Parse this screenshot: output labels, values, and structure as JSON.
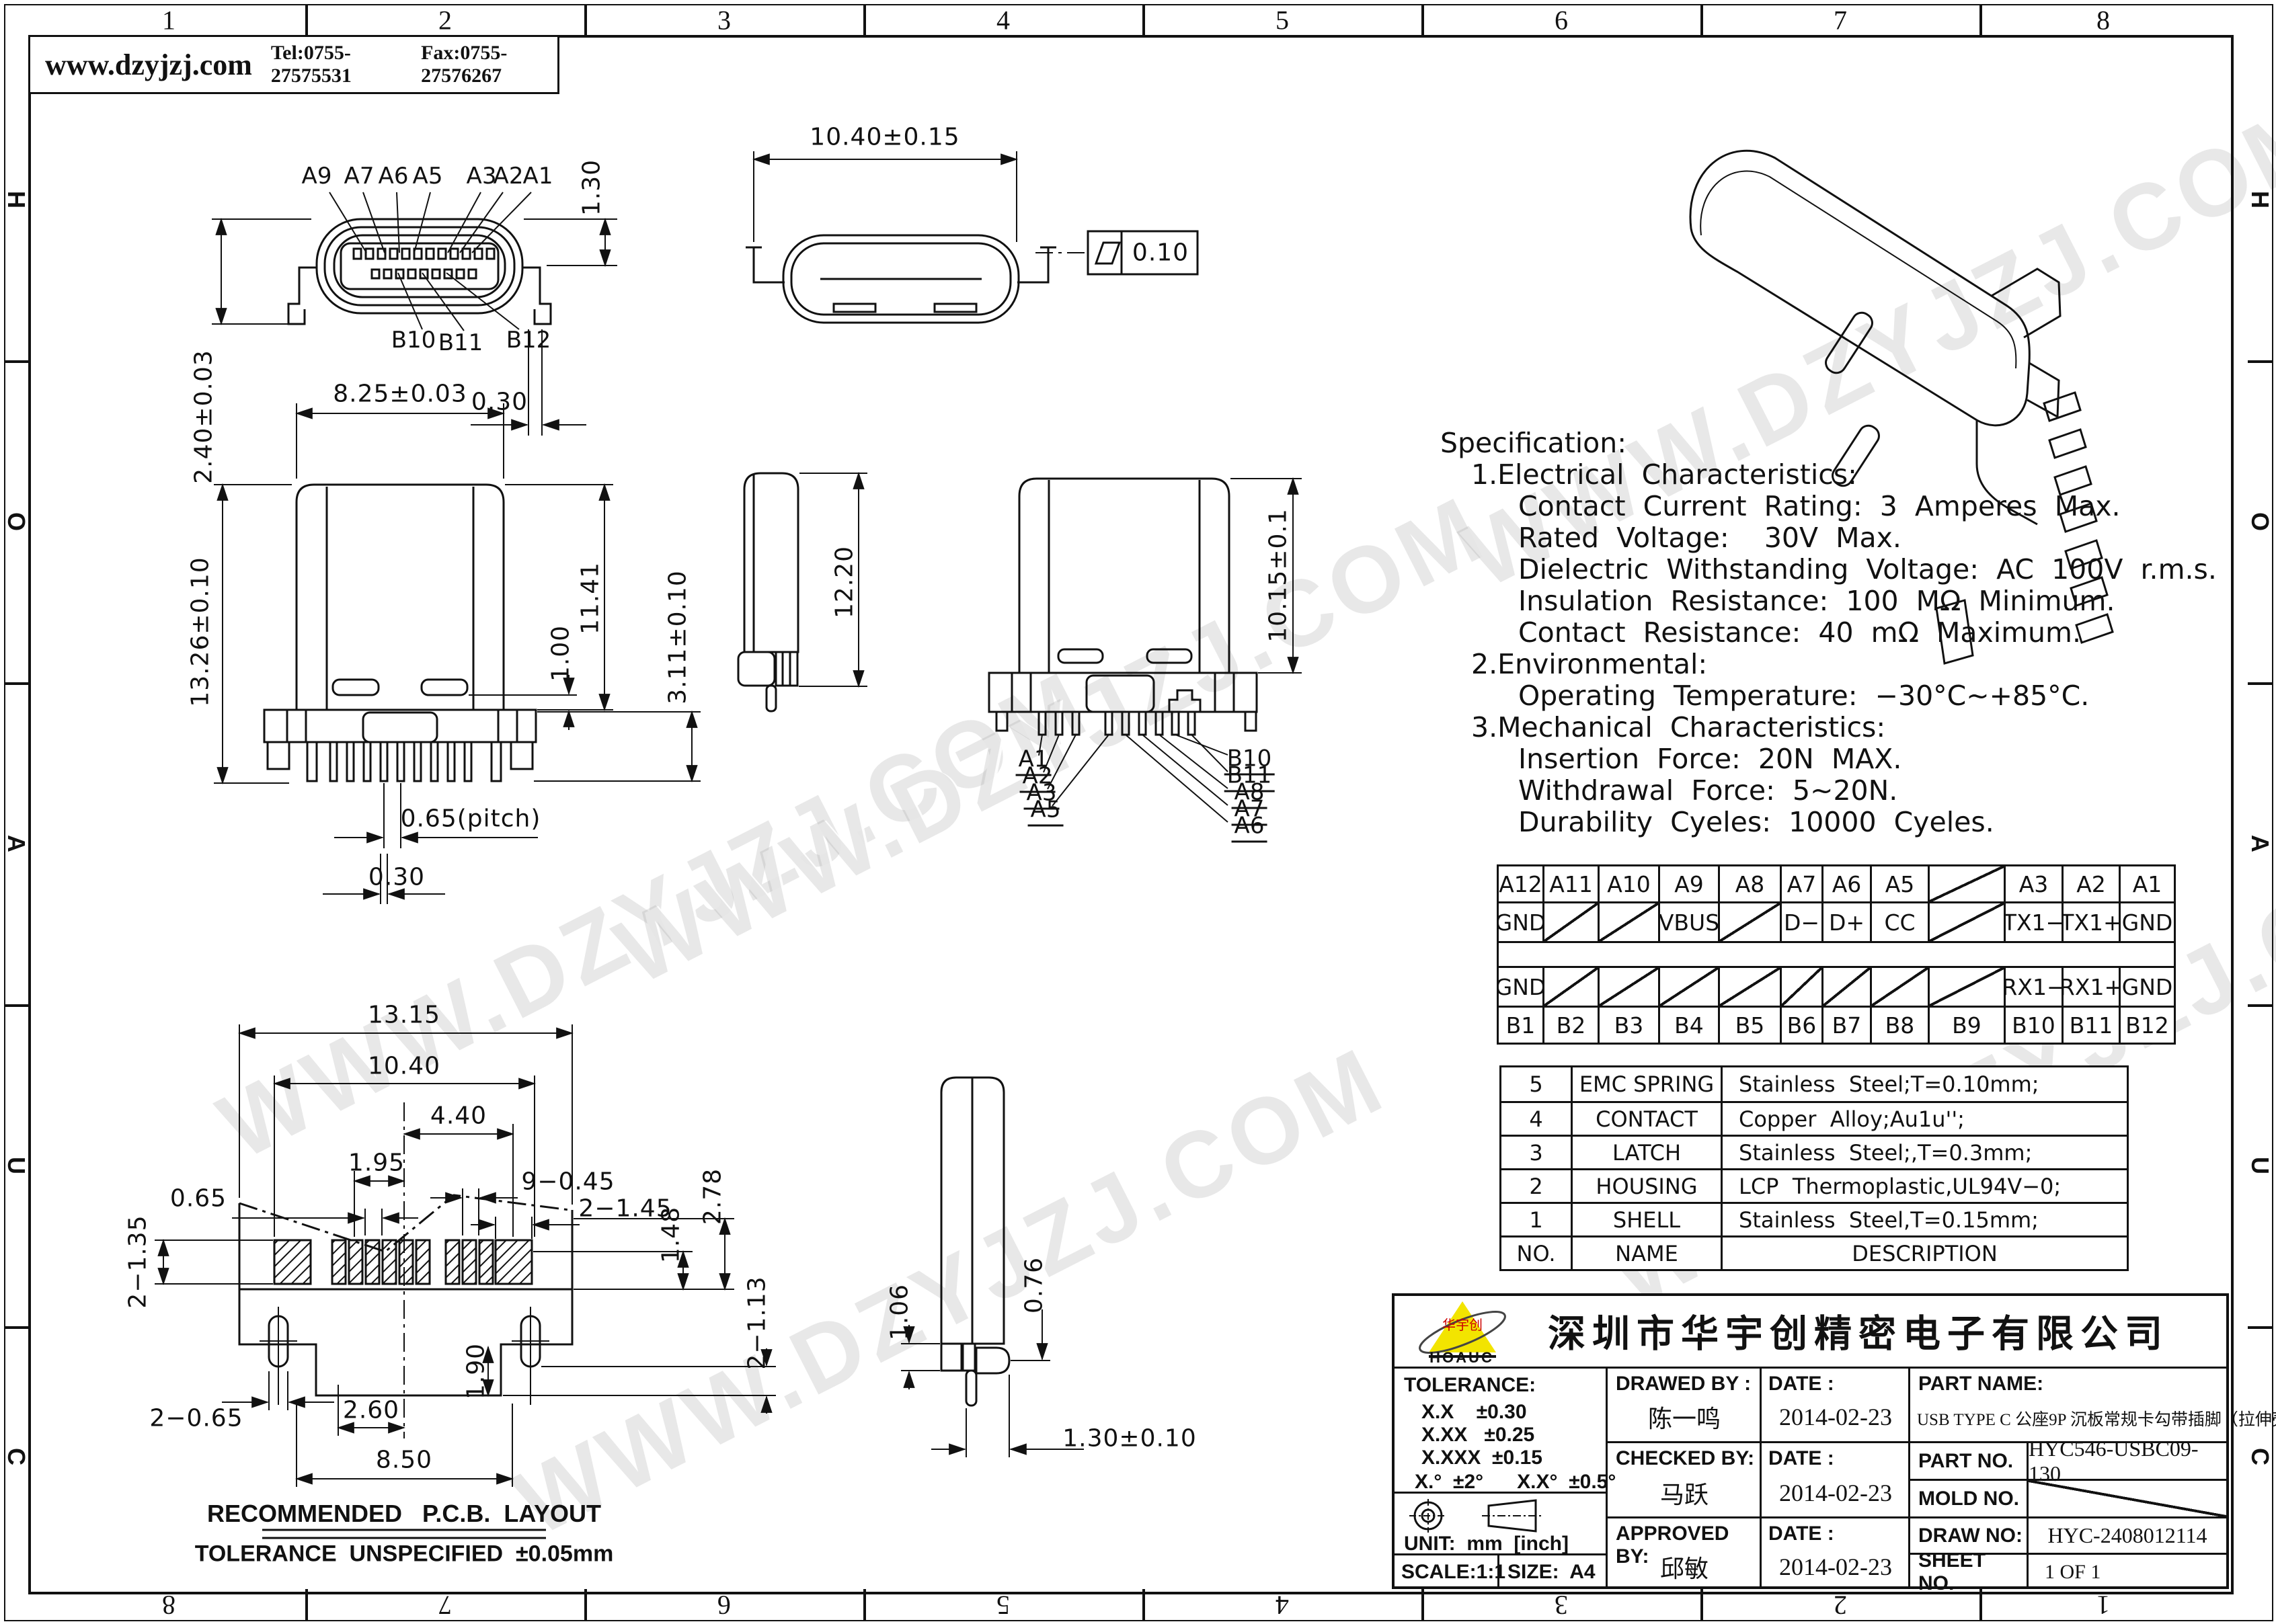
{
  "header": {
    "website": "www.dzyjzj.com",
    "tel": "Tel:0755-27575531",
    "fax": "Fax:0755-27576267"
  },
  "border": {
    "top": [
      "1",
      "2",
      "3",
      "4",
      "5",
      "6",
      "7",
      "8"
    ],
    "bottom": [
      "8",
      "7",
      "6",
      "5",
      "4",
      "3",
      "2",
      "1"
    ],
    "left": [
      "H",
      "O",
      "A",
      "U",
      "C"
    ],
    "right": [
      "H",
      "O",
      "A",
      "U",
      "C"
    ]
  },
  "watermark": {
    "text": "WWW.DZYJZJ.COM"
  },
  "views": {
    "face": {
      "labels_top": [
        "A9",
        "A7",
        "A6",
        "A5",
        "A3",
        "A2",
        "A1"
      ],
      "labels_bottom": [
        "B10",
        "B11",
        "B12"
      ],
      "dim_flange": "1.30",
      "dim_total": "2.40±0.03",
      "dim_offset": "0.30"
    },
    "top": {
      "dim_width": "10.40±0.15",
      "flatness": "0.10"
    },
    "front": {
      "dim_width": "8.25±0.03",
      "dim_height": "13.26±0.10",
      "dim_body": "11.41",
      "dim_slot": "1.00",
      "dim_tail": "3.11±0.10",
      "dim_pitch": "0.65(pitch)",
      "dim_pin": "0.30"
    },
    "side": {
      "dim_height": "12.20"
    },
    "front2": {
      "dim_height": "10.15±0.1",
      "callouts_left": [
        "A1",
        "A2",
        "A3",
        "A5"
      ],
      "callouts_right": [
        "B10",
        "B11",
        "A8",
        "A7",
        "A6"
      ]
    },
    "pcb": {
      "d1": "13.15",
      "d2": "10.40",
      "d3": "4.40",
      "d4": "1.95",
      "d5": "9−0.45",
      "d6": "0.65",
      "d7": "2−1.35",
      "d8": "2−1.45",
      "d9": "1.48",
      "d10": "2.78",
      "d11": "2−1.13",
      "d12": "2−0.65",
      "d13": "2.60",
      "d14": "1.90",
      "d15": "8.50",
      "title": "RECOMMENDED   P.C.B.  LAYOUT",
      "note": "TOLERANCE  UNSPECIFIED  ±0.05mm"
    },
    "pin_side": {
      "d1": "1.06",
      "d2": "0.76",
      "d3": "1.30±0.10"
    }
  },
  "specification": {
    "lines": [
      "Specification:",
      "1.Electrical  Characteristics:",
      "Contact  Current  Rating:  3  Amperes  Max.",
      "Rated  Voltage:    30V  Max.",
      "Dielectric  Withstanding  Voltage:  AC  100V  r.m.s.",
      "Insulation  Resistance:  100  MΩ  Minimum.",
      "Contact  Resistance:  40  mΩ  Maximum.",
      "2.Environmental:",
      "Operating  Temperature:  −30°C~+85°C.",
      "3.Mechanical  Characteristics:",
      "Insertion  Force:  20N  MAX.",
      "Withdrawal  Force:  5~20N.",
      "Durability  Cyeles:  10000  Cyeles."
    ]
  },
  "pin_table": {
    "row_a_pins": [
      "A12",
      "A11",
      "A10",
      "A9",
      "A8",
      "A7",
      "A6",
      "A5",
      "",
      "A3",
      "A2",
      "A1"
    ],
    "row_a_func": [
      "GND",
      "",
      "",
      "VBUS",
      "",
      "D−",
      "D+",
      "CC",
      "",
      "TX1−",
      "TX1+",
      "GND"
    ],
    "row_b_func": [
      "GND",
      "",
      "",
      "",
      "",
      "",
      "",
      "",
      "",
      "RX1−",
      "RX1+",
      "GND"
    ],
    "row_b_pins": [
      "B1",
      "B2",
      "B3",
      "B4",
      "B5",
      "B6",
      "B7",
      "B8",
      "B9",
      "B10",
      "B11",
      "B12"
    ]
  },
  "parts_table": {
    "header": {
      "no": "NO.",
      "name": "NAME",
      "desc": "DESCRIPTION"
    },
    "rows": [
      {
        "no": "5",
        "name": "EMC SPRING",
        "desc": "Stainless  Steel;T=0.10mm;"
      },
      {
        "no": "4",
        "name": "CONTACT",
        "desc": "Copper  Alloy;Au1u'';"
      },
      {
        "no": "3",
        "name": "LATCH",
        "desc": "Stainless  Steel;,T=0.3mm;"
      },
      {
        "no": "2",
        "name": "HOUSING",
        "desc": "LCP  Thermoplastic,UL94V−0;"
      },
      {
        "no": "1",
        "name": "SHELL",
        "desc": "Stainless  Steel,T=0.15mm;"
      }
    ]
  },
  "title_block": {
    "company": "深圳市华宇创精密电子有限公司",
    "logo_text": "华宇创",
    "logo_sub": "HOAUC",
    "tolerance_label": "TOLERANCE:",
    "tol1": "X.X    ±0.30",
    "tol2": "X.XX   ±0.25",
    "tol3": "X.XXX  ±0.15",
    "tol_angle": "X.°  ±2°      X.X°  ±0.5°",
    "unit": "UNIT:  mm  [inch]",
    "scale": "SCALE:1:1",
    "size": "SIZE:  A4",
    "drawed_label": "DRAWED BY :",
    "drawed_name": "陈一鸣",
    "checked_label": "CHECKED BY:",
    "checked_name": "马跃",
    "approved_label": "APPROVED BY:",
    "approved_name": "邱敏",
    "date_label": "DATE :",
    "date1": "2014-02-23",
    "date2": "2014-02-23",
    "date3": "2014-02-23",
    "part_name_label": "PART NAME:",
    "part_name": "USB TYPE C 公座9P 沉板常规卡勾带插脚（拉伸壳）",
    "part_no_label": "PART NO.",
    "part_no": "HYC546-USBC09-130",
    "mold_label": "MOLD NO.",
    "draw_label": "DRAW NO:",
    "draw_no": "HYC-2408012114",
    "sheet_label": "SHEET NO.",
    "sheet_no": "1 OF 1"
  }
}
